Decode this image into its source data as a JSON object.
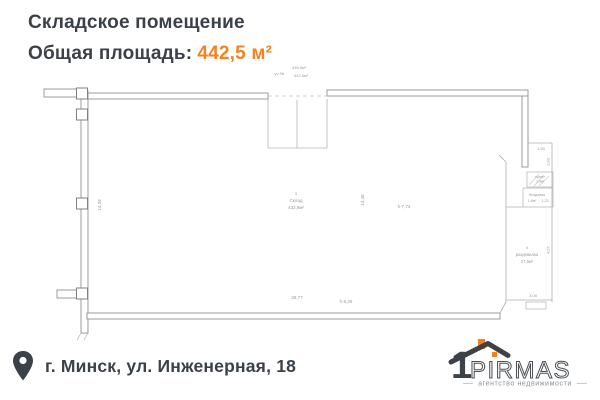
{
  "colors": {
    "accent": "#f5811f",
    "ink": "#3b4148",
    "plan_line": "#9b9b9b"
  },
  "header": {
    "title": "Складское помещение",
    "area_label": "Общая площадь:",
    "area_value": "442,5 м²"
  },
  "plan": {
    "stamp_label": "уч.№",
    "stamp_area1": "439,5м²",
    "stamp_area2": "442,5м²",
    "room1_no": "1",
    "room1_name": "Склад",
    "room1_area": "432,8м²",
    "room2_name": "Кладовая",
    "room2_area": "1,8м²",
    "room2_dim": "1,23",
    "room3_name": "туалет",
    "room3_area": "1,0м²",
    "room4_no": "4",
    "room4_name": "раздевалка",
    "room4_area": "27,5м²",
    "dim_left_wall": "14,39",
    "dim_mid": "14,48",
    "dim_height1": "h-7,74",
    "dim_bottom": "28,77",
    "dim_height2": "h-6,29",
    "dim_150": "1,50",
    "dim_203": "2,03",
    "dim_457": "4,57",
    "dim_308": "3,08"
  },
  "footer": {
    "address": "г. Минск, ул. Инженерная, 18"
  },
  "logo": {
    "one": "1",
    "name": "PIRMAS",
    "tagline": "агентство недвижимости"
  }
}
